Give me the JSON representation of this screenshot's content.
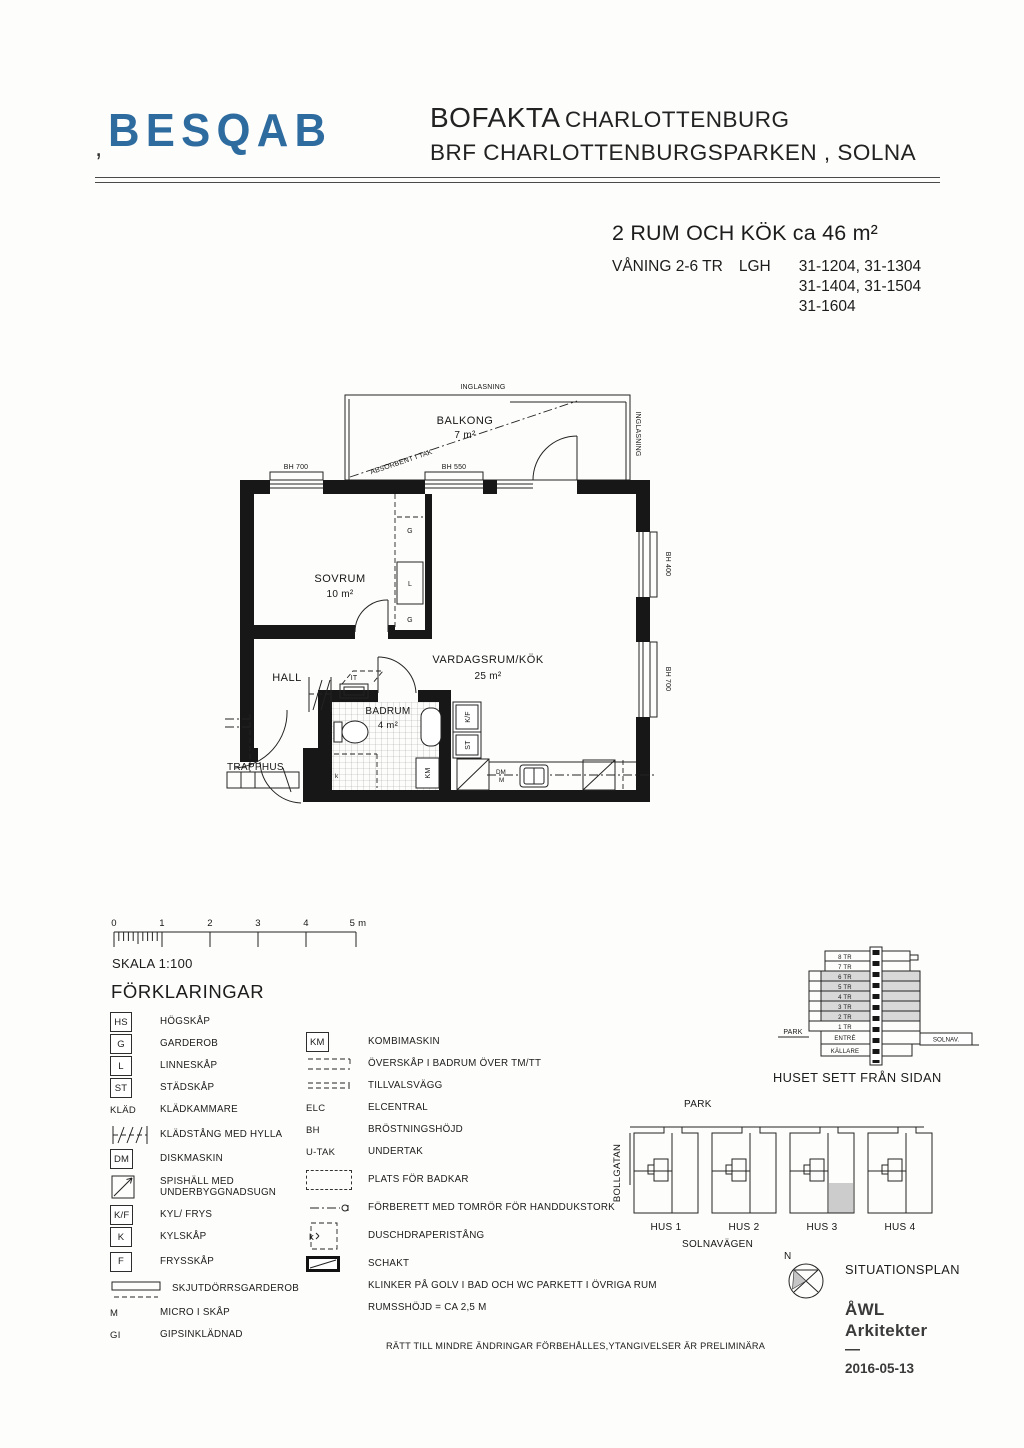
{
  "header": {
    "logo_text": "BESQAB",
    "logo_mark": ",",
    "title_strong": "BOFAKTA",
    "title_rest": "CHARLOTTENBURG",
    "subtitle": "BRF CHARLOTTENBURGSPARKEN , SOLNA"
  },
  "apartment": {
    "headline": "2 RUM OCH KÖK ca 46 m²",
    "floors": "VÅNING 2-6 TR",
    "lgh": "LGH",
    "numbers": [
      "31-1204, 31-1304",
      "31-1404, 31-1504",
      "31-1604"
    ]
  },
  "plan": {
    "balcony_name": "BALKONG",
    "balcony_area": "7 m²",
    "glazing": "INGLASNING",
    "glazing_side": "INGLASNING",
    "absorbent": "ABSORBENT I TAK",
    "win_top_left": "BH 700",
    "win_top_mid": "BH 550",
    "win_right_up": "BH 400",
    "win_right_low": "BH 700",
    "bedroom": "SOVRUM",
    "bedroom_area": "10 m²",
    "living": "VARDAGSRUM/KÖK",
    "living_area": "25 m²",
    "hall": "HALL",
    "bath": "BADRUM",
    "bath_area": "4 m²",
    "stair": "TRAPPHUS",
    "g1": "G",
    "l1": "L",
    "g2": "G",
    "it": "IT",
    "kf": "K/F",
    "st": "ST",
    "km": "KM",
    "dm": "DM",
    "m": "M",
    "shower": "k"
  },
  "scale": {
    "ticks": [
      "0",
      "1",
      "2",
      "3",
      "4"
    ],
    "end": "5 m",
    "label": "SKALA 1:100"
  },
  "legend": {
    "heading": "FÖRKLARINGAR",
    "left": [
      {
        "sym": "HS",
        "label": "HÖGSKÅP"
      },
      {
        "sym": "G",
        "label": "GARDEROB"
      },
      {
        "sym": "L",
        "label": "LINNESKÅP"
      },
      {
        "sym": "ST",
        "label": "STÄDSKÅP"
      },
      {
        "sym": "KLÄD",
        "label": "KLÄDKAMMARE"
      },
      {
        "sym": "",
        "label": "KLÄDSTÅNG MED HYLLA"
      },
      {
        "sym": "DM",
        "label": "DISKMASKIN"
      },
      {
        "sym": "",
        "label": "SPISHÄLL MED UNDERBYGGNADSUGN"
      },
      {
        "sym": "K/F",
        "label": "KYL/ FRYS"
      },
      {
        "sym": "K",
        "label": "KYLSKÅP"
      },
      {
        "sym": "F",
        "label": "FRYSSKÅP"
      },
      {
        "sym": "",
        "label": "SKJUTDÖRRSGARDEROB"
      },
      {
        "sym": "M",
        "label": "MICRO I SKÅP"
      },
      {
        "sym": "GI",
        "label": "GIPSINKLÄDNAD"
      }
    ],
    "right": [
      {
        "sym": "KM",
        "label": "KOMBIMASKIN"
      },
      {
        "sym": "",
        "label": "ÖVERSKÅP I BADRUM ÖVER TM/TT"
      },
      {
        "sym": "",
        "label": "TILLVALSVÄGG"
      },
      {
        "sym": "ELC",
        "label": "ELCENTRAL"
      },
      {
        "sym": "BH",
        "label": "BRÖSTNINGSHÖJD"
      },
      {
        "sym": "U-TAK",
        "label": "UNDERTAK"
      },
      {
        "sym": "",
        "label": "PLATS FÖR BADKAR"
      },
      {
        "sym": "",
        "label": "FÖRBERETT MED TOMRÖR FÖR HANDDUKSTORK"
      },
      {
        "sym": "",
        "label": "DUSCHDRAPERISTÅNG"
      },
      {
        "sym": "",
        "label": "SCHAKT"
      },
      {
        "sym": "",
        "label": "KLINKER PÅ GOLV I BAD OCH WC PARKETT I ÖVRIGA RUM"
      },
      {
        "sym": "",
        "label": "RUMSSHÖJD = CA 2,5 M"
      }
    ]
  },
  "disclaimer": "RÄTT TILL MINDRE ÄNDRINGAR FÖRBEHÅLLES,YTANGIVELSER ÄR PRELIMINÄRA",
  "side_view": {
    "floors": [
      "8 TR",
      "7 TR",
      "6 TR",
      "5 TR",
      "4 TR",
      "3 TR",
      "2 TR",
      "1 TR",
      "ENTRÉ",
      "KÄLLARE"
    ],
    "park": "PARK",
    "street": "SOLNAV.",
    "caption": "HUSET SETT FRÅN SIDAN"
  },
  "site": {
    "park": "PARK",
    "bollgatan": "BOLLGATAN",
    "houses": [
      "HUS 1",
      "HUS 2",
      "HUS 3",
      "HUS 4"
    ],
    "solnavagen": "SOLNAVÄGEN",
    "north": "N",
    "caption": "SITUATIONSPLAN"
  },
  "credits": {
    "firm1": "ÅWL",
    "firm2": "Arkitekter",
    "dash": "—",
    "date": "2016-05-13"
  },
  "colors": {
    "logo_blue": "#2e6b9f",
    "shade": "#d8d8d8"
  }
}
